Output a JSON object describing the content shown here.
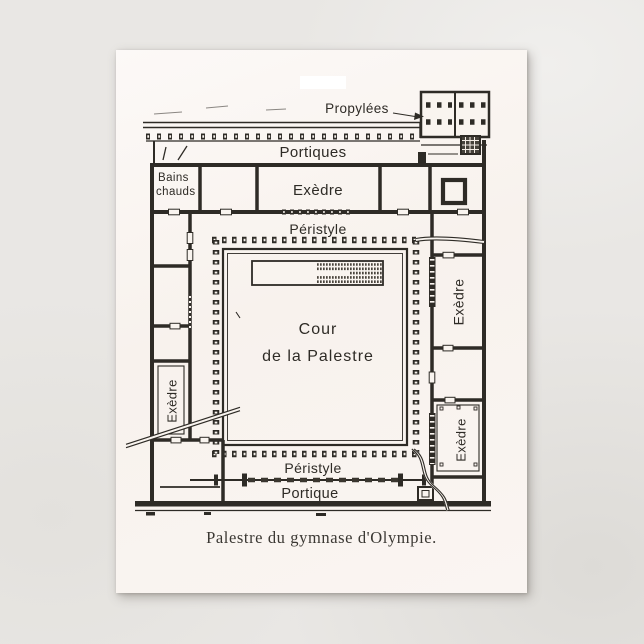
{
  "scene": {
    "background_color": "#e9e7e4"
  },
  "postcard": {
    "card_color": "#faf6f2",
    "ink_color": "#2e2b26",
    "highlight_tab_color": "#ffffff",
    "caption": "Palestre du gymnase d'Olympie.",
    "plan": {
      "labels": {
        "propylees": "Propylées",
        "portiques": "Portiques",
        "bains_chauds_line1": "Bains",
        "bains_chauds_line2": "chauds",
        "exedre_top": "Exèdre",
        "peristyle_top": "Péristyle",
        "cour_line1": "Cour",
        "cour_line2": "de la Palestre",
        "exedre_left": "Exèdre",
        "exedre_right": "Exèdre",
        "exedre_bottom_right": "Exèdre",
        "peristyle_bottom": "Péristyle",
        "portique": "Portique"
      }
    }
  }
}
